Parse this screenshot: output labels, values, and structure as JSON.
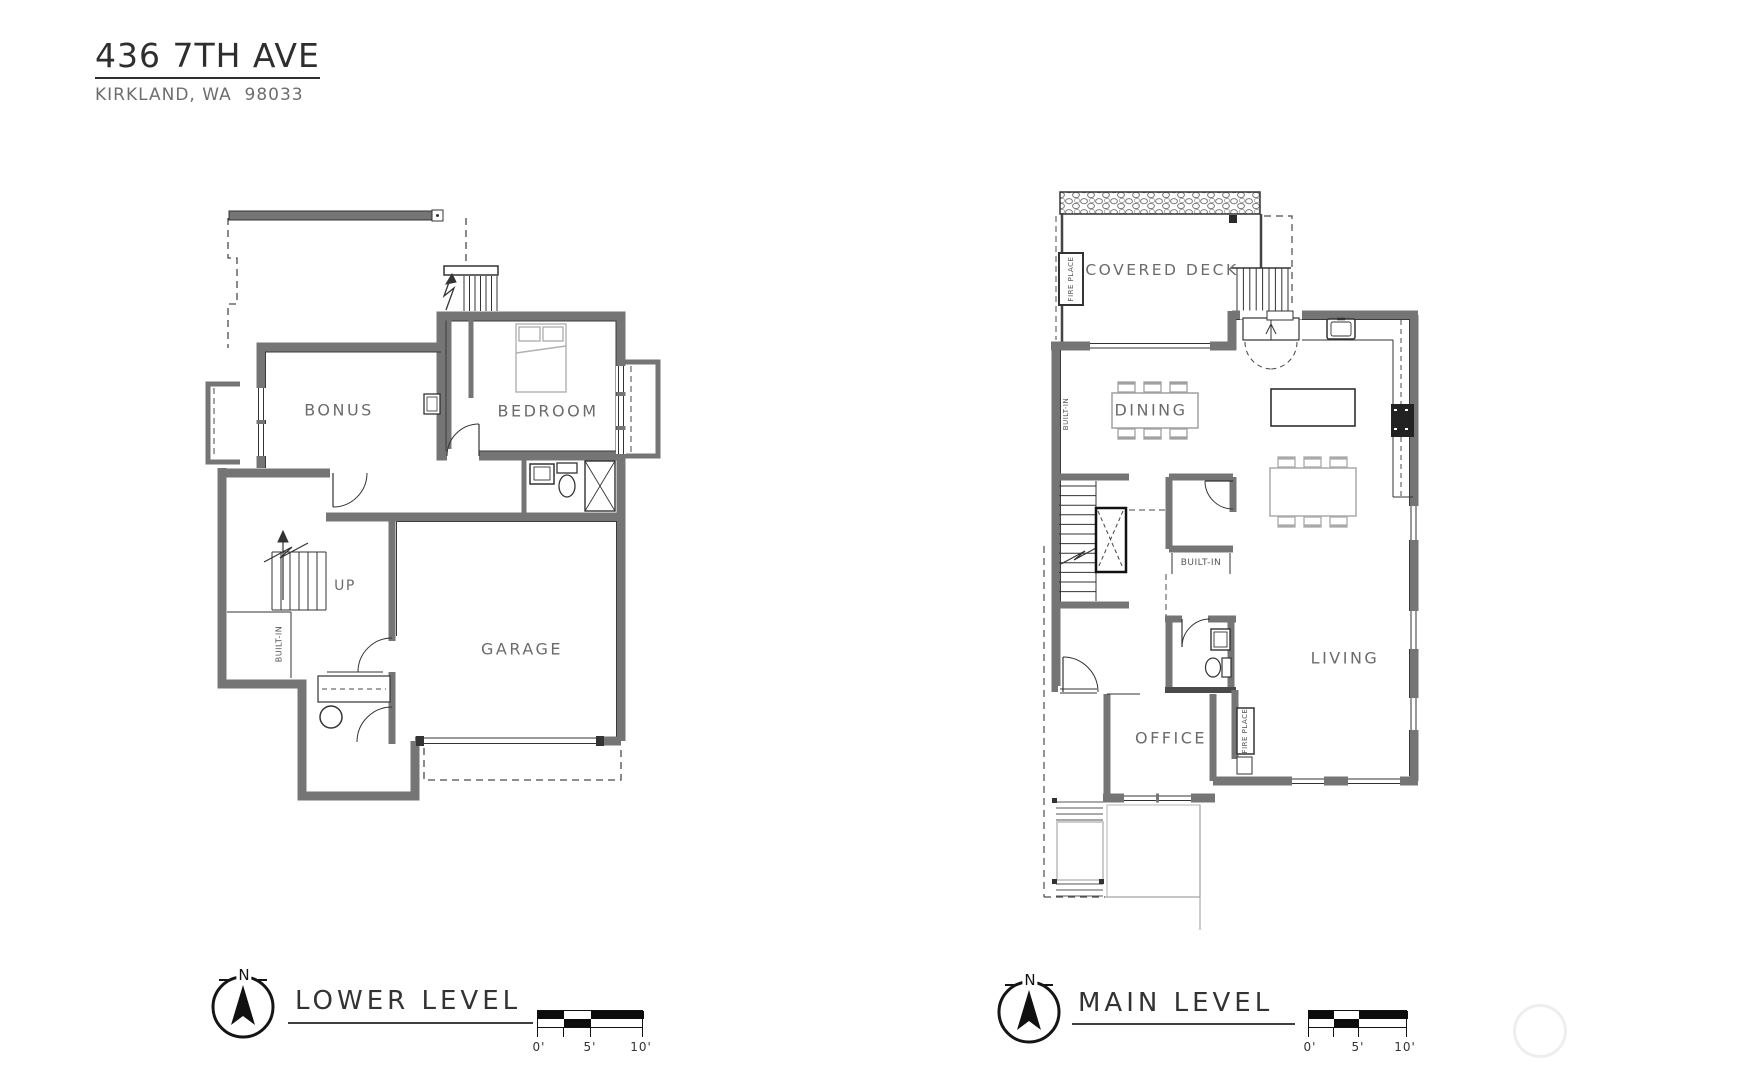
{
  "title": {
    "address": "436 7TH AVE",
    "city": "KIRKLAND, WA  98033"
  },
  "levels": {
    "lower": {
      "name": "LOWER LEVEL",
      "rooms": {
        "bonus": "BONUS",
        "bedroom": "BEDROOM",
        "garage": "GARAGE"
      },
      "up": "UP",
      "built_in": "BUILT-IN"
    },
    "main": {
      "name": "MAIN LEVEL",
      "rooms": {
        "covered_deck": "COVERED DECK",
        "dining": "DINING",
        "living": "LIVING",
        "office": "OFFICE"
      },
      "built_in": "BUILT-IN",
      "fire_place": "FIRE PLACE"
    }
  },
  "compass": {
    "north": "N"
  },
  "scale_bar": {
    "t0": "0'",
    "t5": "5'",
    "t10": "10'"
  },
  "colors": {
    "wall": "#767676",
    "line": "#333333",
    "light": "#aaaaaa",
    "label": "#6b6b6b"
  }
}
